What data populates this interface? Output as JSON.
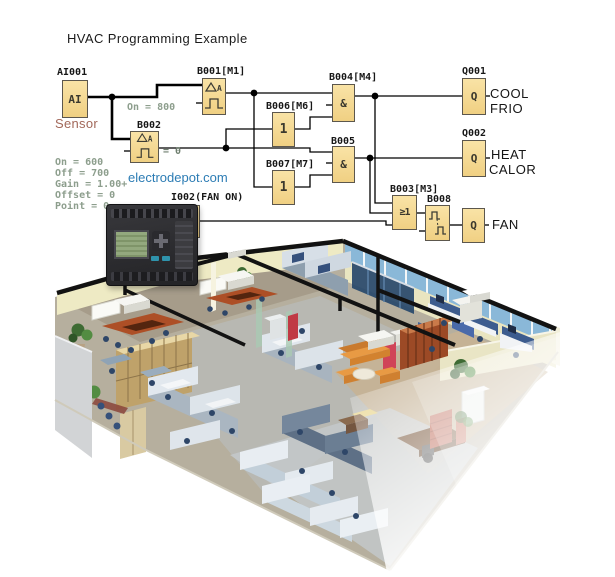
{
  "title": "HVAC Programming Example",
  "watermark": "electrodepot.com",
  "colors": {
    "block_fill": "#F5D88E",
    "block_border": "#5C574D",
    "wire": "#000000",
    "parameter_text": "#8D9E8D",
    "sensor_label": "#A2685A",
    "watermark_text": "#2C7CB4",
    "duct": "#121212",
    "building_wall": "#EEEAC4",
    "building_glass": "#8AB8D8",
    "building_floor": "#B6AF9E"
  },
  "diagram": {
    "inputs": {
      "ai001": {
        "label": "AI001",
        "symbol": "AI",
        "caption": "Sensor"
      },
      "i002": {
        "label": "I002(FAN ON)",
        "symbol": "I"
      }
    },
    "blocks": {
      "b001": {
        "label": "B001[M1]",
        "type": "analog-threshold-trigger",
        "annotation": "On = 800"
      },
      "b002": {
        "label": "B002",
        "type": "analog-threshold-trigger",
        "annotation": "= 0",
        "parameters": [
          "On = 600",
          "Off = 700",
          "Gain = 1.00+",
          "Offset = 0",
          "Point = 0"
        ]
      },
      "b006": {
        "label": "B006[M6]",
        "symbol": "1"
      },
      "b004": {
        "label": "B004[M4]",
        "symbol": "&"
      },
      "b007": {
        "label": "B007[M7]",
        "symbol": "1"
      },
      "b005": {
        "label": "B005",
        "symbol": "&"
      },
      "b003": {
        "label": "B003[M3]",
        "symbol": "≥1"
      },
      "b008": {
        "label": "B008",
        "type": "pulse-relay"
      }
    },
    "outputs": {
      "q001": {
        "label": "Q001",
        "symbol": "Q",
        "caption_line1": "COOL",
        "caption_line2": "FRIO"
      },
      "q002": {
        "label": "Q002",
        "symbol": "Q",
        "caption_line1": "HEAT",
        "caption_line2": "CALOR"
      },
      "q_fan": {
        "symbol": "Q",
        "caption_line1": "FAN"
      }
    }
  }
}
